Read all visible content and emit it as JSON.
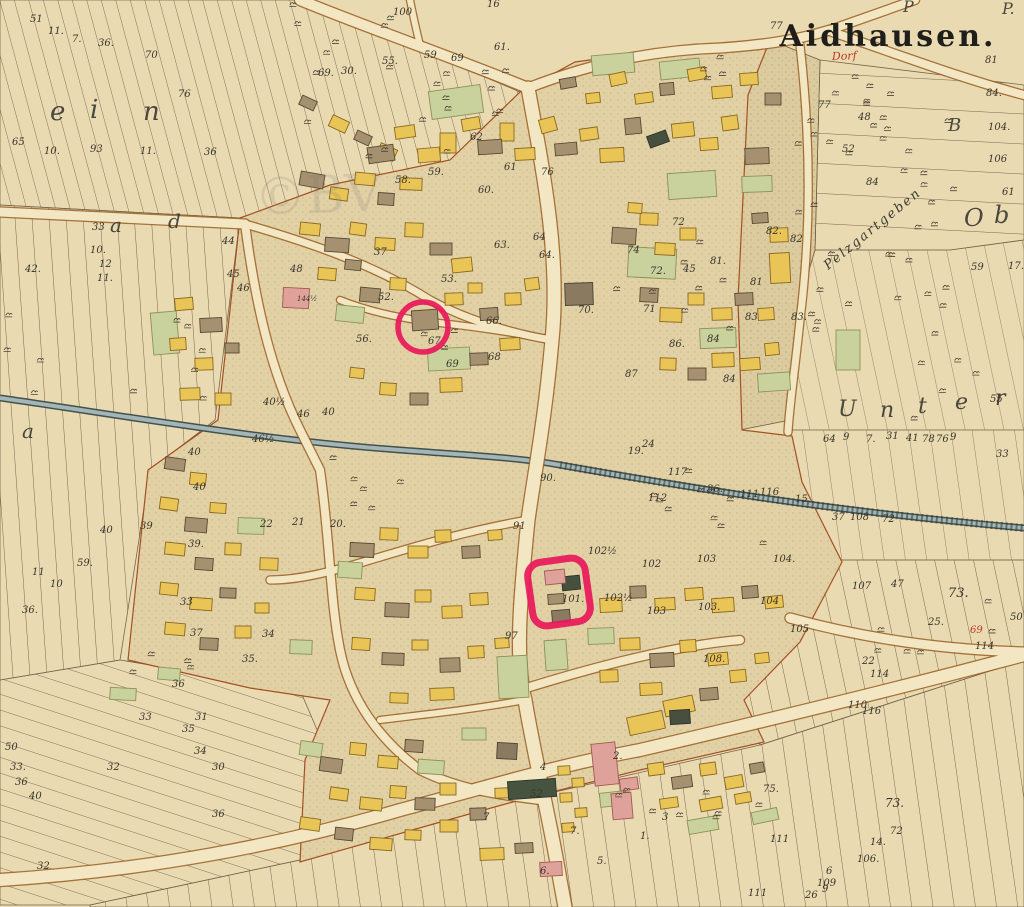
{
  "map": {
    "title": "Aidhausen.",
    "village_label_red": "Dorf",
    "watermark": "©BV",
    "diagonal_field_name": "Pelzgartgeben",
    "annotations": {
      "circle": {
        "plot": "67",
        "cx": 423,
        "cy": 327,
        "r": 25
      },
      "box": {
        "plot": "101",
        "cx": 559,
        "cy": 592,
        "w": 58,
        "h": 64,
        "rot": -8
      }
    },
    "colors": {
      "parchment": "#e9dab2",
      "village_fill": "#e3d1a6",
      "stipple_dot": "#8f7b52",
      "road_fill": "#f3e6c2",
      "road_edge": "#9a6026",
      "stream_fill": "#a3b5b6",
      "stream_edge": "#42514d",
      "building_yellow": "#e9c457",
      "building_brown": "#a59070",
      "building_gray_brown": "#8a7a5f",
      "building_pink": "#dfa29b",
      "building_dark": "#474f3e",
      "garden_green": "#c9d19c",
      "annotation_red": "#e8195a",
      "label_ink": "#38352b",
      "red_ink": "#bf3722",
      "title_ink": "#1f1e1a"
    },
    "field_letters": [
      {
        "t": "e",
        "x": 50,
        "y": 120,
        "s": 26
      },
      {
        "t": "i",
        "x": 90,
        "y": 118,
        "s": 26
      },
      {
        "t": "n",
        "x": 143,
        "y": 120,
        "s": 26
      },
      {
        "t": "a",
        "x": 110,
        "y": 232,
        "s": 20
      },
      {
        "t": "d",
        "x": 168,
        "y": 228,
        "s": 20
      },
      {
        "t": "a",
        "x": 22,
        "y": 438,
        "s": 20
      },
      {
        "t": "U",
        "x": 838,
        "y": 416,
        "s": 22
      },
      {
        "t": "n",
        "x": 880,
        "y": 417,
        "s": 22
      },
      {
        "t": "t",
        "x": 918,
        "y": 413,
        "s": 22
      },
      {
        "t": "e",
        "x": 955,
        "y": 409,
        "s": 22
      },
      {
        "t": "r",
        "x": 995,
        "y": 405,
        "s": 22
      },
      {
        "t": "O",
        "x": 964,
        "y": 226,
        "s": 24
      },
      {
        "t": "b",
        "x": 994,
        "y": 223,
        "s": 24
      },
      {
        "t": "B",
        "x": 948,
        "y": 131,
        "s": 18
      },
      {
        "t": "P",
        "x": 903,
        "y": 12,
        "s": 16
      },
      {
        "t": "P.",
        "x": 1002,
        "y": 14,
        "s": 16
      }
    ],
    "labels": [
      {
        "t": "51",
        "x": 30,
        "y": 22
      },
      {
        "t": "11.",
        "x": 48,
        "y": 34
      },
      {
        "t": "7.",
        "x": 72,
        "y": 42
      },
      {
        "t": "36.",
        "x": 98,
        "y": 46
      },
      {
        "t": "70",
        "x": 145,
        "y": 58
      },
      {
        "t": "76",
        "x": 178,
        "y": 97
      },
      {
        "t": "65",
        "x": 12,
        "y": 145
      },
      {
        "t": "10.",
        "x": 44,
        "y": 154
      },
      {
        "t": "93",
        "x": 90,
        "y": 152
      },
      {
        "t": "11.",
        "x": 140,
        "y": 154
      },
      {
        "t": "36",
        "x": 204,
        "y": 155
      },
      {
        "t": "42.",
        "x": 25,
        "y": 272
      },
      {
        "t": "33",
        "x": 92,
        "y": 230
      },
      {
        "t": "10.",
        "x": 90,
        "y": 253
      },
      {
        "t": "12",
        "x": 99,
        "y": 267
      },
      {
        "t": "11.",
        "x": 97,
        "y": 281
      },
      {
        "t": "44",
        "x": 222,
        "y": 244
      },
      {
        "t": "45",
        "x": 227,
        "y": 277
      },
      {
        "t": "46",
        "x": 237,
        "y": 291
      },
      {
        "t": "48",
        "x": 290,
        "y": 272
      },
      {
        "t": "100",
        "x": 393,
        "y": 15
      },
      {
        "t": "69.",
        "x": 318,
        "y": 76
      },
      {
        "t": "30.",
        "x": 341,
        "y": 74
      },
      {
        "t": "55.",
        "x": 382,
        "y": 64
      },
      {
        "t": "59",
        "x": 424,
        "y": 58
      },
      {
        "t": "69",
        "x": 451,
        "y": 61
      },
      {
        "t": "61.",
        "x": 494,
        "y": 50
      },
      {
        "t": "16",
        "x": 487,
        "y": 7
      },
      {
        "t": "77",
        "x": 770,
        "y": 29
      },
      {
        "t": "77",
        "x": 818,
        "y": 108
      },
      {
        "t": "81",
        "x": 985,
        "y": 63
      },
      {
        "t": "48",
        "x": 858,
        "y": 120
      },
      {
        "t": "52",
        "x": 842,
        "y": 152
      },
      {
        "t": "84",
        "x": 866,
        "y": 185
      },
      {
        "t": "84.",
        "x": 986,
        "y": 96
      },
      {
        "t": "104.",
        "x": 988,
        "y": 130
      },
      {
        "t": "106",
        "x": 988,
        "y": 162
      },
      {
        "t": "61",
        "x": 1002,
        "y": 195
      },
      {
        "t": "59",
        "x": 971,
        "y": 270
      },
      {
        "t": "17.",
        "x": 1008,
        "y": 269
      },
      {
        "t": "58.",
        "x": 395,
        "y": 183
      },
      {
        "t": "59.",
        "x": 428,
        "y": 175
      },
      {
        "t": "60.",
        "x": 478,
        "y": 193
      },
      {
        "t": "61",
        "x": 504,
        "y": 170
      },
      {
        "t": "62",
        "x": 470,
        "y": 140
      },
      {
        "t": "76",
        "x": 541,
        "y": 175
      },
      {
        "t": "63.",
        "x": 494,
        "y": 248
      },
      {
        "t": "64",
        "x": 533,
        "y": 240
      },
      {
        "t": "64.",
        "x": 539,
        "y": 258
      },
      {
        "t": "53.",
        "x": 441,
        "y": 282
      },
      {
        "t": "52.",
        "x": 378,
        "y": 300
      },
      {
        "t": "56.",
        "x": 356,
        "y": 342
      },
      {
        "t": "67.",
        "x": 428,
        "y": 344
      },
      {
        "t": "66.",
        "x": 486,
        "y": 324
      },
      {
        "t": "68",
        "x": 488,
        "y": 360
      },
      {
        "t": "69",
        "x": 446,
        "y": 367
      },
      {
        "t": "70.",
        "x": 578,
        "y": 313
      },
      {
        "t": "37",
        "x": 374,
        "y": 255
      },
      {
        "t": "144½",
        "x": 297,
        "y": 301,
        "s": 7
      },
      {
        "t": "74",
        "x": 627,
        "y": 253
      },
      {
        "t": "72",
        "x": 672,
        "y": 225
      },
      {
        "t": "72.",
        "x": 650,
        "y": 274
      },
      {
        "t": "45",
        "x": 683,
        "y": 272
      },
      {
        "t": "81.",
        "x": 710,
        "y": 264
      },
      {
        "t": "82.",
        "x": 766,
        "y": 234
      },
      {
        "t": "82",
        "x": 790,
        "y": 242
      },
      {
        "t": "81",
        "x": 750,
        "y": 285
      },
      {
        "t": "71",
        "x": 643,
        "y": 312
      },
      {
        "t": "83",
        "x": 745,
        "y": 320
      },
      {
        "t": "84",
        "x": 707,
        "y": 342
      },
      {
        "t": "86.",
        "x": 669,
        "y": 347
      },
      {
        "t": "87",
        "x": 625,
        "y": 377
      },
      {
        "t": "84",
        "x": 723,
        "y": 382
      },
      {
        "t": "83.",
        "x": 791,
        "y": 320
      },
      {
        "t": "40",
        "x": 100,
        "y": 533
      },
      {
        "t": "59.",
        "x": 77,
        "y": 566
      },
      {
        "t": "11",
        "x": 32,
        "y": 575
      },
      {
        "t": "10",
        "x": 50,
        "y": 587
      },
      {
        "t": "36.",
        "x": 22,
        "y": 613
      },
      {
        "t": "40",
        "x": 188,
        "y": 455
      },
      {
        "t": "40",
        "x": 193,
        "y": 490
      },
      {
        "t": "46½",
        "x": 252,
        "y": 442
      },
      {
        "t": "40½",
        "x": 263,
        "y": 405
      },
      {
        "t": "46",
        "x": 297,
        "y": 417
      },
      {
        "t": "40",
        "x": 322,
        "y": 415
      },
      {
        "t": "39",
        "x": 140,
        "y": 529
      },
      {
        "t": "39.",
        "x": 188,
        "y": 547
      },
      {
        "t": "22",
        "x": 260,
        "y": 527
      },
      {
        "t": "21",
        "x": 292,
        "y": 525
      },
      {
        "t": "20.",
        "x": 330,
        "y": 527
      },
      {
        "t": "33",
        "x": 180,
        "y": 605
      },
      {
        "t": "37",
        "x": 190,
        "y": 636
      },
      {
        "t": "35.",
        "x": 242,
        "y": 662
      },
      {
        "t": "34",
        "x": 262,
        "y": 637
      },
      {
        "t": "90.",
        "x": 540,
        "y": 481
      },
      {
        "t": "91",
        "x": 513,
        "y": 529
      },
      {
        "t": "117",
        "x": 668,
        "y": 475
      },
      {
        "t": "112",
        "x": 648,
        "y": 501
      },
      {
        "t": "36.",
        "x": 707,
        "y": 492
      },
      {
        "t": "111",
        "x": 740,
        "y": 497
      },
      {
        "t": "116",
        "x": 760,
        "y": 495
      },
      {
        "t": "15",
        "x": 795,
        "y": 502
      },
      {
        "t": "37",
        "x": 832,
        "y": 520
      },
      {
        "t": "108",
        "x": 850,
        "y": 520
      },
      {
        "t": "72",
        "x": 882,
        "y": 522
      },
      {
        "t": "19.",
        "x": 628,
        "y": 454
      },
      {
        "t": "24",
        "x": 642,
        "y": 447
      },
      {
        "t": "102",
        "x": 642,
        "y": 567
      },
      {
        "t": "103",
        "x": 697,
        "y": 562
      },
      {
        "t": "104.",
        "x": 773,
        "y": 562
      },
      {
        "t": "104",
        "x": 760,
        "y": 604
      },
      {
        "t": "103.",
        "x": 698,
        "y": 610
      },
      {
        "t": "102½",
        "x": 604,
        "y": 601
      },
      {
        "t": "105",
        "x": 790,
        "y": 632
      },
      {
        "t": "107",
        "x": 852,
        "y": 589
      },
      {
        "t": "47",
        "x": 891,
        "y": 587
      },
      {
        "t": "73.",
        "x": 948,
        "y": 597,
        "s": 13
      },
      {
        "t": "101.",
        "x": 562,
        "y": 602
      },
      {
        "t": "102½",
        "x": 588,
        "y": 554
      },
      {
        "t": "103",
        "x": 647,
        "y": 614
      },
      {
        "t": "97",
        "x": 505,
        "y": 639
      },
      {
        "t": "108.",
        "x": 703,
        "y": 662
      },
      {
        "t": "52",
        "x": 530,
        "y": 797
      },
      {
        "t": "4",
        "x": 540,
        "y": 770
      },
      {
        "t": "7.",
        "x": 570,
        "y": 834
      },
      {
        "t": "2.",
        "x": 613,
        "y": 759
      },
      {
        "t": "6.",
        "x": 540,
        "y": 874
      },
      {
        "t": "5.",
        "x": 597,
        "y": 864
      },
      {
        "t": "3",
        "x": 662,
        "y": 820
      },
      {
        "t": "7",
        "x": 483,
        "y": 820
      },
      {
        "t": "1.",
        "x": 640,
        "y": 839
      },
      {
        "t": "75.",
        "x": 763,
        "y": 792
      },
      {
        "t": "111",
        "x": 770,
        "y": 842
      },
      {
        "t": "111",
        "x": 748,
        "y": 896
      },
      {
        "t": "26",
        "x": 805,
        "y": 898
      },
      {
        "t": "109",
        "x": 817,
        "y": 886
      },
      {
        "t": "9",
        "x": 822,
        "y": 892
      },
      {
        "t": "6",
        "x": 826,
        "y": 874
      },
      {
        "t": "106.",
        "x": 857,
        "y": 862
      },
      {
        "t": "14.",
        "x": 870,
        "y": 845
      },
      {
        "t": "72",
        "x": 890,
        "y": 834
      },
      {
        "t": "73.",
        "x": 885,
        "y": 807,
        "s": 12
      },
      {
        "t": "25.",
        "x": 928,
        "y": 625
      },
      {
        "t": "50",
        "x": 1010,
        "y": 620
      },
      {
        "t": "69",
        "x": 970,
        "y": 633,
        "c": "red"
      },
      {
        "t": "114",
        "x": 975,
        "y": 649
      },
      {
        "t": "114",
        "x": 870,
        "y": 677
      },
      {
        "t": "22",
        "x": 862,
        "y": 664
      },
      {
        "t": "116",
        "x": 862,
        "y": 714
      },
      {
        "t": "110",
        "x": 848,
        "y": 708
      },
      {
        "t": "50",
        "x": 5,
        "y": 750
      },
      {
        "t": "33.",
        "x": 10,
        "y": 770
      },
      {
        "t": "36",
        "x": 15,
        "y": 785
      },
      {
        "t": "40",
        "x": 29,
        "y": 799
      },
      {
        "t": "32",
        "x": 107,
        "y": 770
      },
      {
        "t": "36",
        "x": 172,
        "y": 687
      },
      {
        "t": "33",
        "x": 139,
        "y": 720
      },
      {
        "t": "31",
        "x": 195,
        "y": 720
      },
      {
        "t": "35",
        "x": 182,
        "y": 732
      },
      {
        "t": "34",
        "x": 194,
        "y": 754
      },
      {
        "t": "30",
        "x": 212,
        "y": 770
      },
      {
        "t": "32",
        "x": 37,
        "y": 869
      },
      {
        "t": "36",
        "x": 212,
        "y": 817
      },
      {
        "t": "64",
        "x": 823,
        "y": 442
      },
      {
        "t": "9",
        "x": 843,
        "y": 440
      },
      {
        "t": "7.",
        "x": 866,
        "y": 442
      },
      {
        "t": "31",
        "x": 886,
        "y": 439
      },
      {
        "t": "41",
        "x": 906,
        "y": 441
      },
      {
        "t": "78",
        "x": 922,
        "y": 442
      },
      {
        "t": "76",
        "x": 936,
        "y": 442
      },
      {
        "t": "9",
        "x": 950,
        "y": 440
      },
      {
        "t": "55",
        "x": 990,
        "y": 402
      },
      {
        "t": "33",
        "x": 996,
        "y": 457
      }
    ]
  }
}
